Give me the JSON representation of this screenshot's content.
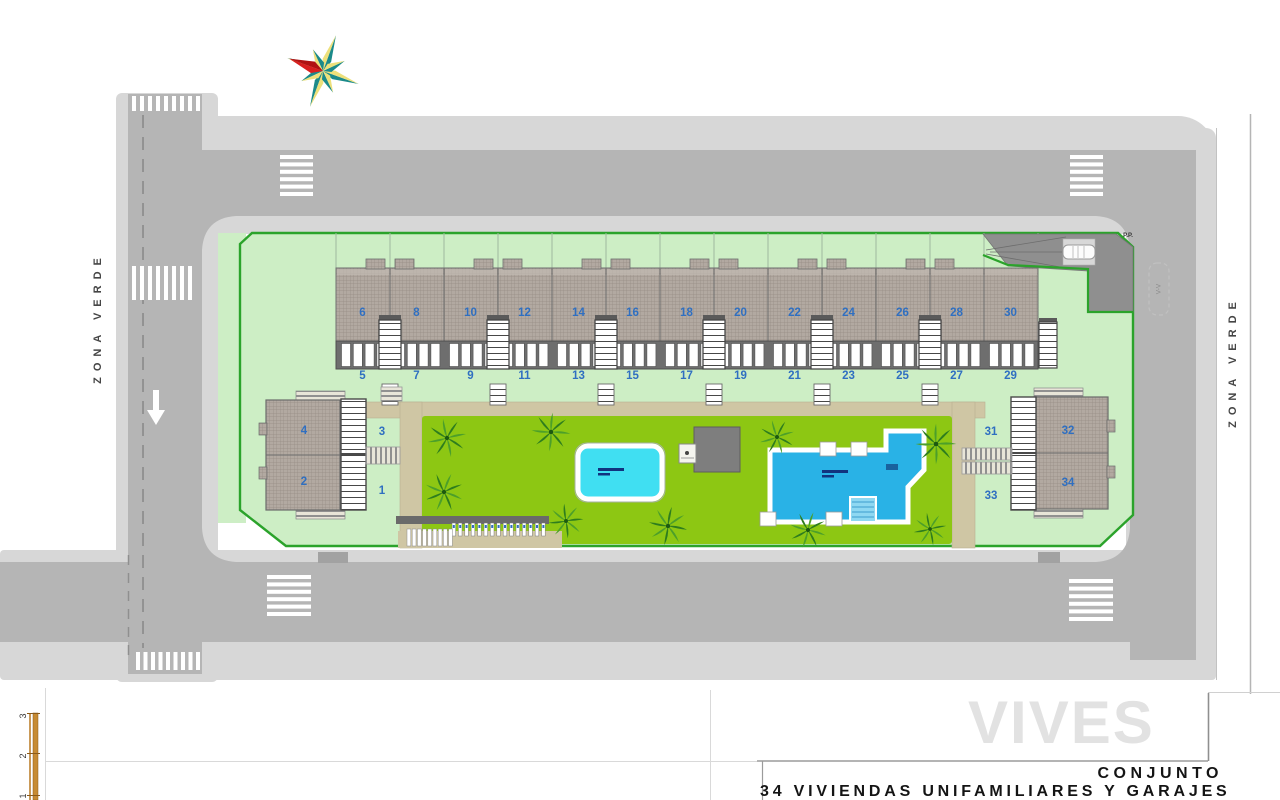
{
  "title_block": {
    "project_type": "CONJUNTO",
    "project_name": "34 VIVIENDAS UNIFAMILIARES Y GARAJES"
  },
  "watermark": "VIVES",
  "zona_verde_left": "ZONA VERDE",
  "zona_verde_right": "ZONA VERDE",
  "ramp_label": "P.P.",
  "road_marking": "V-V",
  "scale_ticks": [
    "3",
    "2",
    "1"
  ],
  "houses": {
    "even_row": [
      "6",
      "8",
      "10",
      "12",
      "14",
      "16",
      "18",
      "20",
      "22",
      "24",
      "26",
      "28",
      "30"
    ],
    "odd_row": [
      "5",
      "7",
      "9",
      "11",
      "13",
      "15",
      "17",
      "19",
      "21",
      "23",
      "25",
      "27",
      "29"
    ]
  },
  "west_building": {
    "unit_upper": "4",
    "unit_lower": "2",
    "garden_upper": "3",
    "garden_lower": "1"
  },
  "east_building": {
    "unit_upper": "32",
    "unit_lower": "34",
    "garden_upper": "31",
    "garden_lower": "33"
  },
  "colors": {
    "sidewalk": "#d7d7d7",
    "road": "#b5b5b5",
    "ramp": "#8f8f8f",
    "parcel": "#cdeec5",
    "border_green": "#2ba32b",
    "lawn": "#8dc713",
    "path_tan": "#cfc6a4",
    "roof": "#b2a9a1",
    "number_blue": "#2f6fc1",
    "pool_small": "#40dff2",
    "pool_large": "#29b2e6",
    "scale_orange": "#c78b33"
  }
}
